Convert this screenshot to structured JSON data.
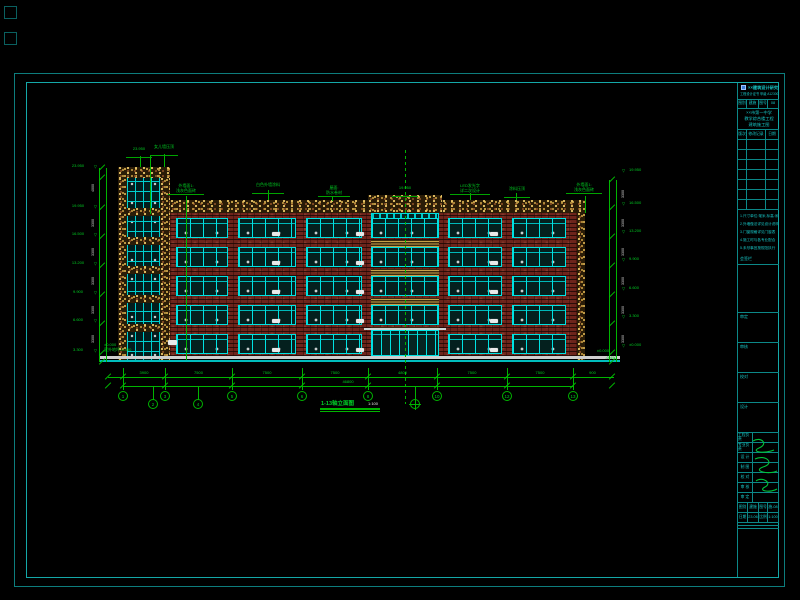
{
  "sheet": {
    "background": "#000000",
    "border_color": "#11a0a0",
    "line_green": "#00b400",
    "line_cyan": "#00e2e2",
    "brick_color": "#6d241b",
    "stone_color": "#d9b050"
  },
  "elevation": {
    "title": "1-13轴立面图",
    "scale": "1:100",
    "tower_callouts": [
      {
        "lines": [
          "23.950",
          ""
        ]
      },
      {
        "lines": [
          "女儿墙压顶",
          ""
        ]
      }
    ],
    "roof_callouts": [
      {
        "lines": [
          "外墙面1:",
          "浅灰色面砖"
        ]
      },
      {
        "lines": [
          "白色外墙涂料",
          ""
        ]
      },
      {
        "lines": [
          "屋面:",
          "防水卷材"
        ]
      },
      {
        "lines": [
          "19.950",
          ""
        ]
      },
      {
        "lines": [
          "LED发光字",
          "详二次设计"
        ]
      },
      {
        "lines": [
          "涂料压顶",
          ""
        ]
      },
      {
        "lines": [
          "外墙面1:",
          "浅灰色面砖"
        ]
      }
    ],
    "levels_left": [
      "23.950",
      "19.950",
      "16.500",
      "13.200",
      "9.900",
      "6.600",
      "3.300"
    ],
    "levels_right": [
      "19.950",
      "16.500",
      "13.200",
      "9.900",
      "6.600",
      "3.300",
      "±0.000"
    ],
    "floor_heights_left": [
      "4000",
      "3300",
      "3300",
      "3300",
      "3300",
      "3300"
    ],
    "floor_heights_right": [
      "3300",
      "3300",
      "3300",
      "3300",
      "3300",
      "3300"
    ],
    "ground_note_lines": [
      "±0.000",
      "室外地坪-0.450"
    ],
    "ground_right_marks": [
      "±0.000",
      "-0.450"
    ],
    "dims_bays": [
      "3900",
      "7500",
      "7500",
      "7500",
      "4800",
      "7500",
      "7500",
      "900"
    ],
    "dim_overall": "46800",
    "axis_bubbles": [
      "1",
      "3",
      "5",
      "6",
      "8",
      "10",
      "12",
      "13"
    ],
    "sub_bubbles": [
      "2",
      "4"
    ]
  },
  "titleblock": {
    "company": "××建筑设计研究院有限公司",
    "cert": "工程设计证书 甲级 A123004567",
    "header_cells": [
      "图别",
      "建施",
      "图号",
      "08"
    ],
    "project_lines": [
      "××市第一中学",
      "教学综合楼工程",
      "建筑施工图"
    ],
    "revision_header": [
      "版次",
      "修改记录",
      "日期"
    ],
    "notes": [
      "1.尺寸单位:毫米,标高:米",
      "2.外墙做法详见设计说明",
      "3.门窗规格详见门窗表",
      "4.施工时与各专业配合",
      "5.未尽事宜按规范执行"
    ],
    "sign_label": "会签栏",
    "stage_boxes": [
      "审定",
      "审核",
      "校对",
      "设计"
    ],
    "staff_rows": [
      [
        "工程负责",
        ""
      ],
      [
        "专业负责",
        ""
      ],
      [
        "设 计",
        ""
      ],
      [
        "制 图",
        ""
      ],
      [
        "校 对",
        ""
      ],
      [
        "审 核",
        ""
      ],
      [
        "审 定",
        ""
      ]
    ],
    "bottom_rows": [
      [
        "图别",
        "建施",
        "图号",
        "施-08"
      ],
      [
        "日期",
        "23.06",
        "比例",
        "1:100"
      ]
    ]
  }
}
